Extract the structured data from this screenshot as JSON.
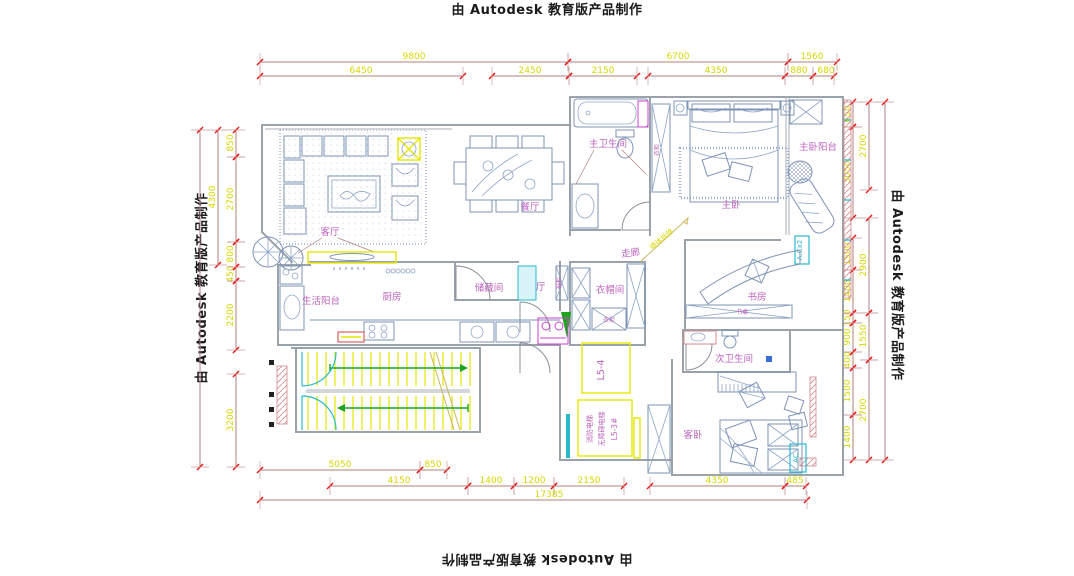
{
  "watermark": {
    "text": "由 Autodesk 教育版产品制作"
  },
  "rooms": {
    "living": "客厅",
    "dining": "餐厅",
    "master_bath": "主卫生间",
    "master_bed": "主卧",
    "master_balcony": "主卧阳台",
    "corridor": "走廊",
    "cloakroom": "衣帽间",
    "foyer": "门厅",
    "storage": "储藏间",
    "service_balcony": "生活阳台",
    "kitchen": "厨房",
    "study": "书房",
    "second_bath": "次卫生间",
    "guest_bed": "客卧"
  },
  "annotations": {
    "fire_elevator": "消防电梯",
    "accessible_elevator": "无障碍电梯",
    "elevator_code": "L5-3#",
    "shaft_code": "L5-4",
    "ac_unit": "AC",
    "ac_unit2": "A.Cx2",
    "demolition_note": "墙体拆除",
    "wardrobe_label": "衣柜",
    "cloak_wardrobe_label": "衣柜",
    "shoe_cabinet_label": "鞋柜",
    "desk_label": "书桌"
  },
  "dimensions": {
    "top_outer": [
      "9800",
      "6700",
      "1560"
    ],
    "top_inner": [
      "6450",
      "2450",
      "2150",
      "4350",
      "880",
      "680"
    ],
    "left_inner": [
      "850",
      "2700",
      "800",
      "450",
      "2200",
      "3200"
    ],
    "left_mid": [
      "4300"
    ],
    "right_inner": [
      "650",
      "3050",
      "1500",
      "1400",
      "150",
      "900",
      "400",
      "1500",
      "1400"
    ],
    "right_mid": [
      "2700",
      "2900",
      "1550",
      "2700"
    ],
    "bottom_inner": [
      "5050",
      "850"
    ],
    "bottom_main": [
      "4150",
      "1400",
      "1200",
      "2150",
      "4350",
      "485"
    ],
    "bottom_total": "17385"
  },
  "colors": {
    "dimension_line": "#b28080",
    "dimension_tick": "#ee1111",
    "dimension_text": "#d6d600",
    "room_label": "#bd65bd",
    "wall": "#9aa2aa",
    "furniture": "#7e93b6",
    "door_window_cyan": "#2ab8cf",
    "fixture_magenta": "#cf3fcf",
    "stair_tread_yellow": "#e6e600",
    "direction_arrow_green": "#1fa31f",
    "hatched_wall_pink": "#d28a8a",
    "watermark_text": "#1b1b1b"
  }
}
